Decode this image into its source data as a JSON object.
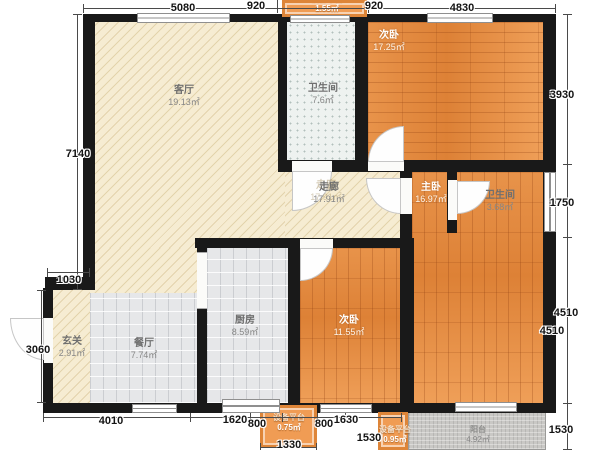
{
  "rooms": {
    "living": {
      "label": "客厅",
      "area": "19.13㎡"
    },
    "hallway": {
      "label": "走廊",
      "area": "17.91㎡"
    },
    "bath_main": {
      "label": "卫生间",
      "area": "7.6㎡"
    },
    "bedroom_top": {
      "label": "次卧",
      "area": "17.25㎡"
    },
    "master": {
      "label": "主卧",
      "area": "16.97㎡"
    },
    "bath_master": {
      "label": "卫生间",
      "area": "3.68㎡"
    },
    "bedroom_bottom": {
      "label": "次卧",
      "area": "11.55㎡"
    },
    "kitchen": {
      "label": "厨房",
      "area": "8.59㎡"
    },
    "dining": {
      "label": "餐厅",
      "area": "7.74㎡"
    },
    "foyer": {
      "label": "玄关",
      "area": "2.91㎡"
    },
    "balcony": {
      "label": "阳台",
      "area": "4.92㎡"
    },
    "platform_top": {
      "label": "设备平台",
      "area": "1.55㎡"
    },
    "platform_mid": {
      "label": "设备平台",
      "area": "0.75㎡"
    },
    "platform_right": {
      "label": "设备平台",
      "area": "0.95㎡"
    }
  },
  "dimensions": {
    "top": [
      "5080",
      "920",
      "920",
      "4830"
    ],
    "left": [
      "7140",
      "1030",
      "3060"
    ],
    "right": [
      "3930",
      "1750",
      "4510",
      "4510",
      "1530"
    ],
    "bottom": [
      "4010",
      "1620",
      "800",
      "800",
      "1630",
      "1530",
      "1330"
    ]
  },
  "colors": {
    "wall": "#191919",
    "wood": "#e58d42",
    "hatch_beige": "#f6ecd2",
    "tile_gray": "#e6e7e9",
    "bath_tile": "#eef2f0",
    "balcony_gray": "#c9c8c5",
    "platform_orange": "#f09c54",
    "dim_text": "#141414"
  }
}
